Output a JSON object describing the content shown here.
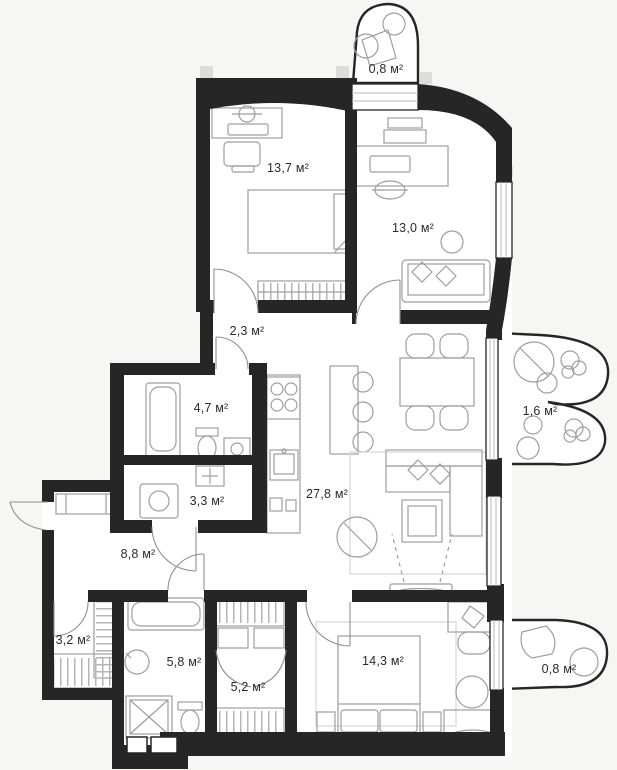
{
  "plan": {
    "unit_suffix": "м²",
    "areas": [
      {
        "id": "balcony-top",
        "label": "0,8 м²"
      },
      {
        "id": "bedroom-upper",
        "label": "13,7 м²"
      },
      {
        "id": "office",
        "label": "13,0 м²"
      },
      {
        "id": "hallway",
        "label": "2,3 м²"
      },
      {
        "id": "bathroom-upper",
        "label": "4,7 м²"
      },
      {
        "id": "balcony-right",
        "label": "1,6 м²"
      },
      {
        "id": "laundry",
        "label": "3,3 м²"
      },
      {
        "id": "kitchen-living",
        "label": "27,8 м²"
      },
      {
        "id": "corridor",
        "label": "8,8 м²"
      },
      {
        "id": "closet",
        "label": "3,2 м²"
      },
      {
        "id": "bathroom-lower",
        "label": "5,8 м²"
      },
      {
        "id": "wardrobe",
        "label": "5,2 м²"
      },
      {
        "id": "bedroom-lower",
        "label": "14,3 м²"
      },
      {
        "id": "balcony-bottom",
        "label": "0,8 м²"
      }
    ],
    "colors": {
      "wall": "#262626",
      "room": "#ffffff",
      "furniture": "#9e9e9e",
      "background": "#f6f6f5"
    }
  }
}
